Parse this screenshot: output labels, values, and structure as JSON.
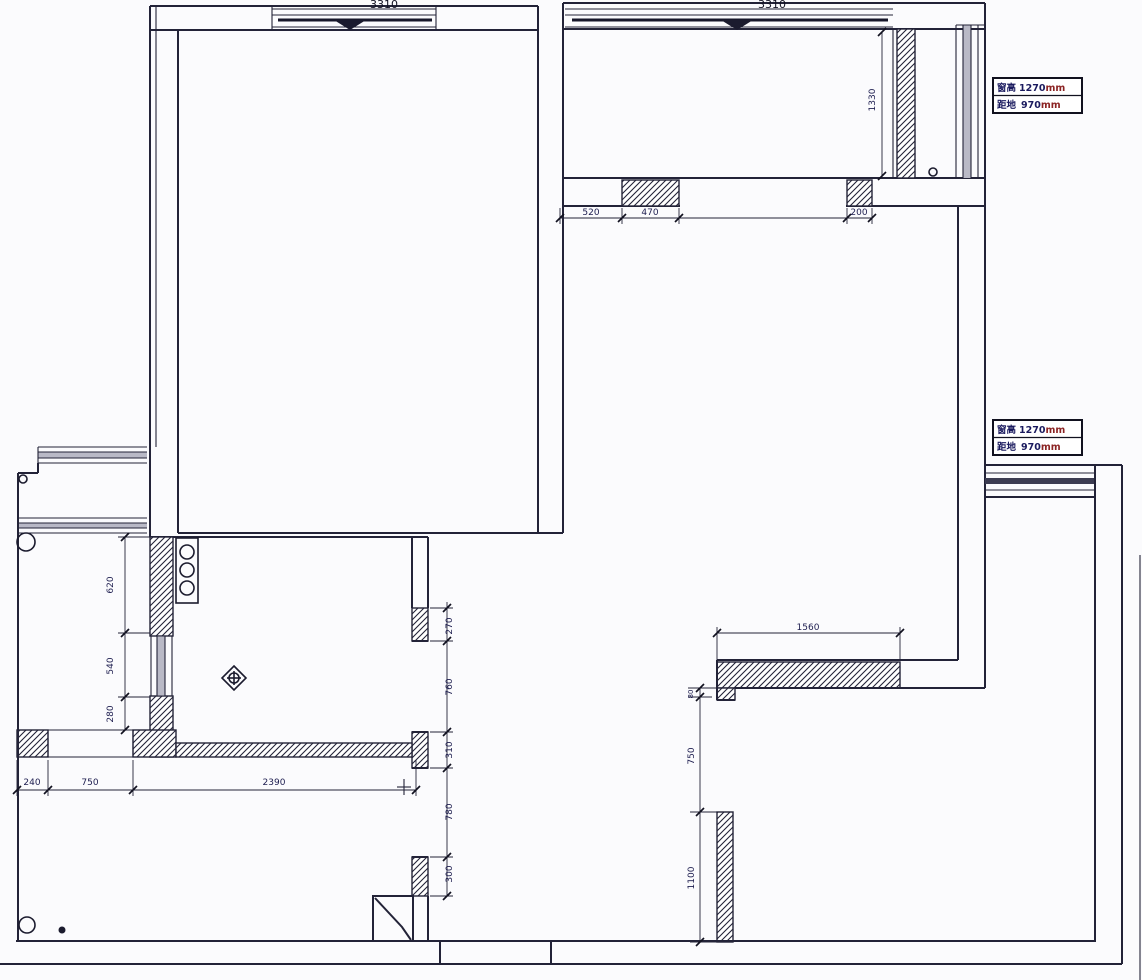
{
  "drawing": {
    "type": "apartment floor plan (CAD)",
    "colors": {
      "background": "#fbfbfd",
      "line": "#232338",
      "hatch": "#232338",
      "dim_text": "#1d1d4f",
      "unit_red": "#8b2323",
      "window_gray": "#b9b9c6"
    },
    "dims": {
      "top_left_width": "3310",
      "top_right_width": "3310",
      "balcony_depth": "1330",
      "seg_520": "520",
      "seg_470": "470",
      "seg_200": "200",
      "ledge_width": "1560",
      "kitchen_620": "620",
      "kitchen_540": "540",
      "kitchen_280": "280",
      "east_270": "270",
      "east_760": "760",
      "east_310": "310",
      "east_780": "780",
      "east_300": "300",
      "south_240": "240",
      "south_750": "750",
      "south_2390": "2390",
      "hall_80": "80",
      "hall_750": "750",
      "hall_1100": "1100"
    },
    "window_annotation": {
      "height_label": "窗高",
      "height_value": "1270",
      "floor_label": "距地",
      "floor_value": "970",
      "unit": "mm"
    }
  }
}
